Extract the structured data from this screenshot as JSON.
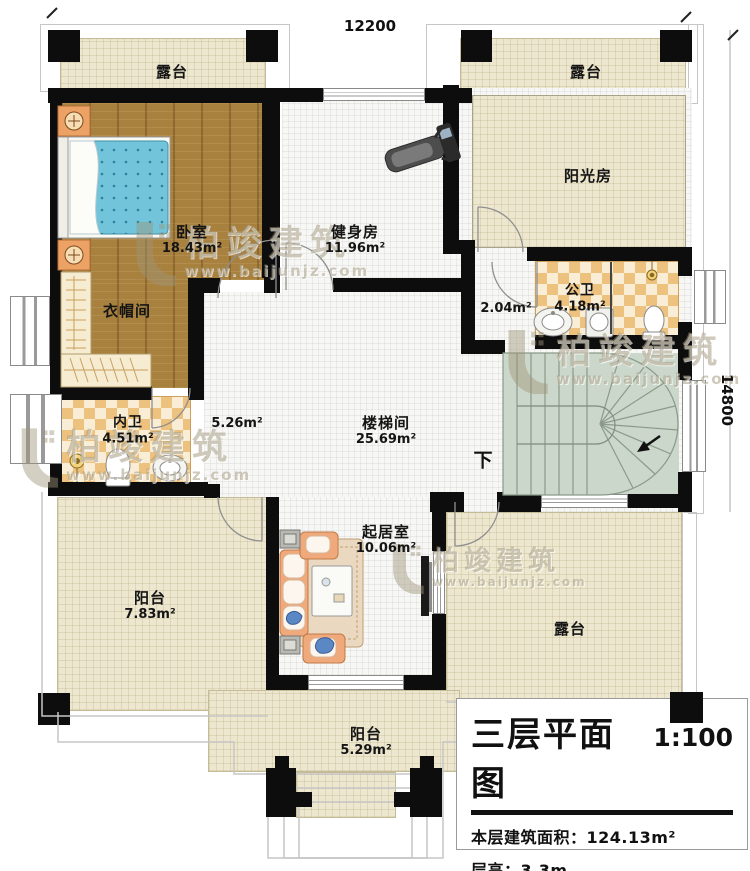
{
  "dimensions": {
    "top": "12200",
    "right": "14800"
  },
  "rooms": {
    "terrace_tl": {
      "label": "露台"
    },
    "terrace_tr": {
      "label": "露台"
    },
    "sunroom": {
      "label": "阳光房"
    },
    "bedroom": {
      "label": "卧室",
      "area": "18.43m²"
    },
    "gym": {
      "label": "健身房",
      "area": "11.96m²"
    },
    "public_bath": {
      "label": "公卫",
      "area": "4.18m²"
    },
    "hall": {
      "area": "2.04m²"
    },
    "closet": {
      "label": "衣帽间"
    },
    "private_bath": {
      "label": "内卫",
      "area": "4.51m²"
    },
    "corridor": {
      "area": "5.26m²"
    },
    "stairwell": {
      "label": "楼梯间",
      "area": "25.69m²"
    },
    "down": {
      "label": "下"
    },
    "living": {
      "label": "起居室",
      "area": "10.06m²"
    },
    "balcony_left": {
      "label": "阳台",
      "area": "7.83m²"
    },
    "terrace_br": {
      "label": "露台"
    },
    "balcony_bottom": {
      "label": "阳台",
      "area": "5.29m²"
    }
  },
  "title_block": {
    "title": "三层平面图",
    "scale": "1:100",
    "area_label": "本层建筑面积：",
    "area_value": "124.13m²",
    "floor_height_label": "层高：",
    "floor_height_value": "3.3m"
  },
  "watermark": {
    "brand": "柏竣建筑",
    "url": "www.baijunjz.com"
  },
  "colors": {
    "wall": "#0d0d0d",
    "wood_floor": "#a8813f",
    "terrace": "#ede7cf",
    "tile": "#f7f7f5",
    "bath_checker": "#ecc27e",
    "stair": "#ccd7cb",
    "bed": "#72c4da"
  }
}
